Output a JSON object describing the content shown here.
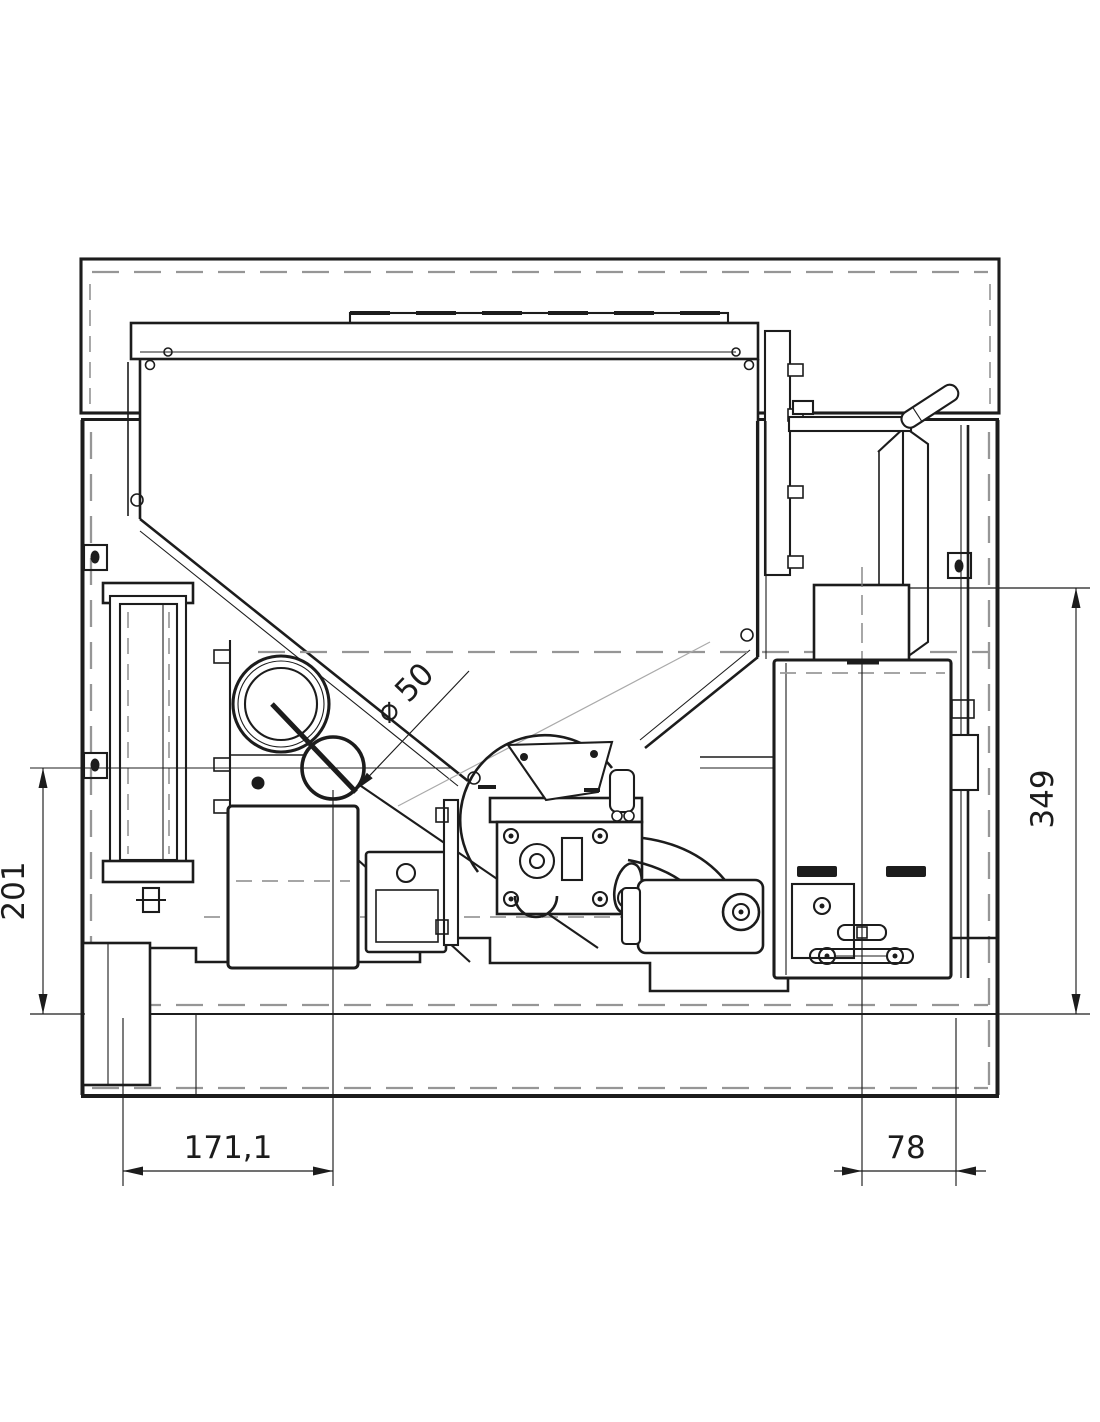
{
  "drawing": {
    "dimensions": {
      "left_height": "201",
      "right_height": "349",
      "bottom_left_width": "171,1",
      "bottom_right_width": "78",
      "tube_diameter": "⌀ 50"
    },
    "colors": {
      "background": "#ffffff",
      "line": "#1c1c1c",
      "hidden_line": "#969696"
    }
  }
}
